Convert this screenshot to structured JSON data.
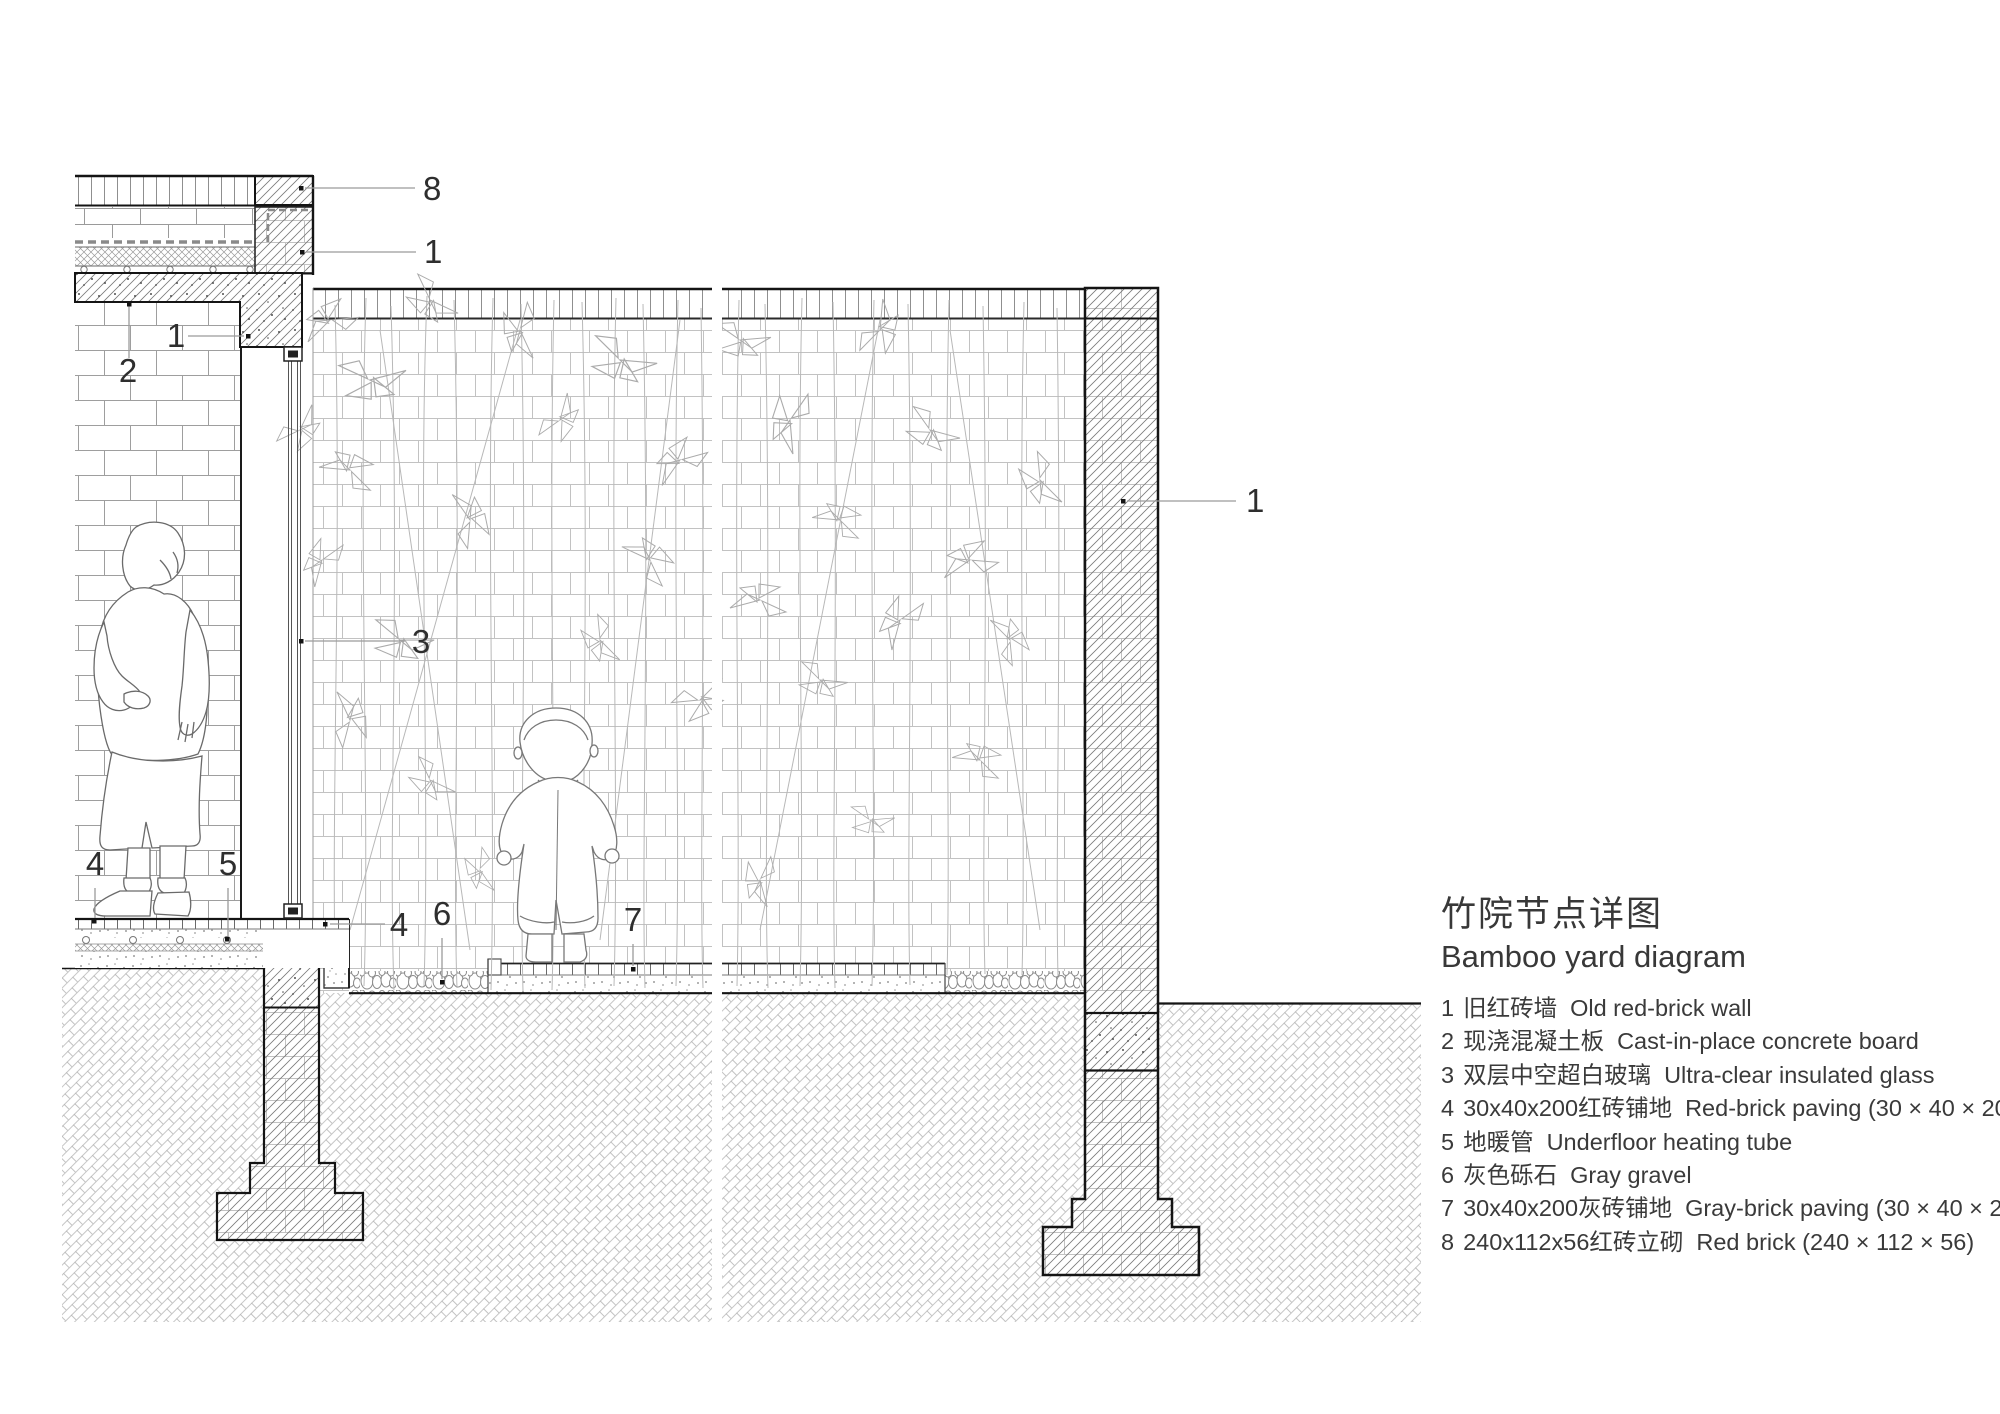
{
  "title": {
    "zh": "竹院节点详图",
    "en": "Bamboo yard diagram"
  },
  "legend": [
    {
      "no": "1",
      "zh": "旧红砖墙",
      "en": "Old red-brick wall"
    },
    {
      "no": "2",
      "zh": "现浇混凝土板",
      "en": "Cast-in-place concrete board"
    },
    {
      "no": "3",
      "zh": "双层中空超白玻璃",
      "en": "Ultra-clear insulated glass"
    },
    {
      "no": "4",
      "zh": "30x40x200红砖铺地",
      "en": "Red-brick paving (30 × 40 × 200)"
    },
    {
      "no": "5",
      "zh": "地暖管",
      "en": "Underfloor heating tube"
    },
    {
      "no": "6",
      "zh": "灰色砾石",
      "en": "Gray gravel"
    },
    {
      "no": "7",
      "zh": "30x40x200灰砖铺地",
      "en": "Gray-brick paving (30 × 40 × 200)"
    },
    {
      "no": "8",
      "zh": "240x112x56红砖立砌",
      "en": "Red brick (240 × 112 × 56)"
    }
  ],
  "callouts": {
    "c8": "8",
    "c1_roof": "1",
    "c2": "2",
    "c1_beam": "1",
    "c3": "3",
    "c4_floor": "4",
    "c5": "5",
    "c4_edge": "4",
    "c6": "6",
    "c7": "7",
    "c1_wall": "1"
  },
  "colors": {
    "background": "#ffffff",
    "cut_line": "#141414",
    "leader_line": "#9b9b9b",
    "text": "#2e2e2e",
    "hatch": "#787878",
    "brick_light": "#c2c2c2",
    "brick_mid": "#9e9e9e"
  }
}
